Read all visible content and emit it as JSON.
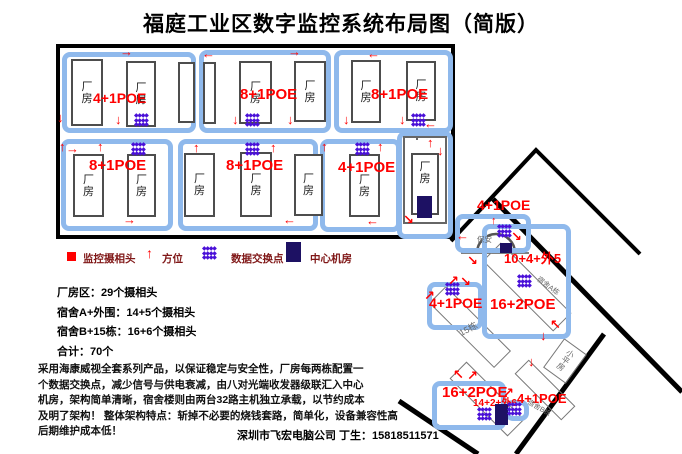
{
  "title": "福庭工业区数字监控系统布局图（简版）",
  "icons": {
    "arrow_up": "↑",
    "arrow_down": "↓",
    "arrow_left": "←",
    "arrow_right": "→",
    "arrow_up_right": "↗",
    "arrow_down_right": "↘",
    "arrow_up_left": "↖",
    "arrow_down_left": "↙",
    "switch_cluster": "◆◆◆◆\n◆◆◆◆\n◆◆◆◆"
  },
  "factory": {
    "room_label": "厂房",
    "blocks": [
      {
        "poe": "4+1POE"
      },
      {
        "poe": "8+1POE"
      },
      {
        "poe": "8+1POE"
      },
      {
        "poe": "8+1POE"
      },
      {
        "poe": "8+1POE"
      },
      {
        "poe": "4+1POE"
      }
    ]
  },
  "dorm": {
    "booth_poe": "4+1POE",
    "booth_label": "保安",
    "gate_count": "10+4+外5",
    "dorm_a_poe": "16+2POE",
    "dorm_a_label": "宿舍A栋",
    "b15_poe": "4+1POE",
    "b15_label": "15栋",
    "bungalow_label": "小平房",
    "dorm_b_poe": "16+2POE",
    "dorm_b_count": "14+2+外6",
    "dorm_b_side_poe": "4+1POE",
    "dorm_b_label": "宿舍B栋"
  },
  "legend": {
    "camera": "监控摄相头",
    "direction": "方位",
    "switch": "数据交换点",
    "server_room": "中心机房"
  },
  "stats": "厂房区：29个摄相头\n宿舍A+外围：14+5个摄相头\n宿舍B+15栋：16+6个摄相头\n合计：70个",
  "description": "采用海康威视全套系列产品，以保证稳定与安全性，厂房每两栋配置一\n个数据交换点，减少信号与供电衰减，由八对光端收发器级联汇入中心\n机房，架构简单清晰，宿舍楼则由两台32路主机独立承载，以节约成本\n及明了架构！ 整体架构特点：斩掉不必要的烧钱套路，简单化，设备兼容性高\n后期维护成本低！",
  "footer": "深圳市飞宏电脑公司 丁生：15818511571",
  "colors": {
    "poe_red": "#ff0000",
    "switch_purple": "#4a10d8",
    "server_navy": "#1d1163",
    "zone_blue": "#8fb9ec"
  }
}
